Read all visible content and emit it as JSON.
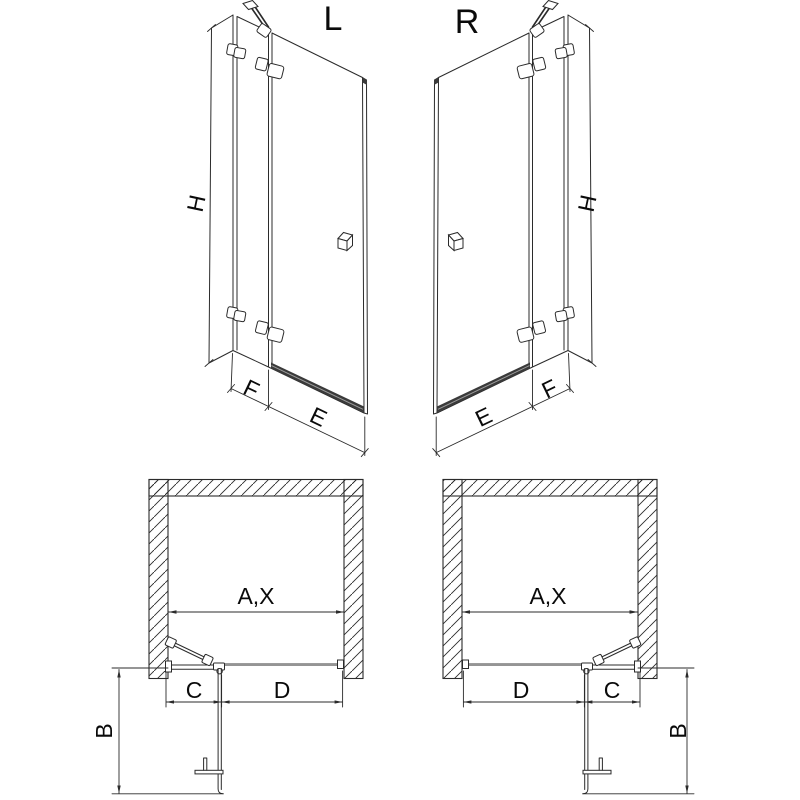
{
  "diagram": {
    "variant_left": {
      "title": "L"
    },
    "variant_right": {
      "title": "R"
    },
    "dims": {
      "height": "H",
      "door_entry": "E",
      "fixed_panel": "F",
      "niche_width": "A,X",
      "projection": "B",
      "fixed_segment": "C",
      "door_segment": "D"
    }
  }
}
